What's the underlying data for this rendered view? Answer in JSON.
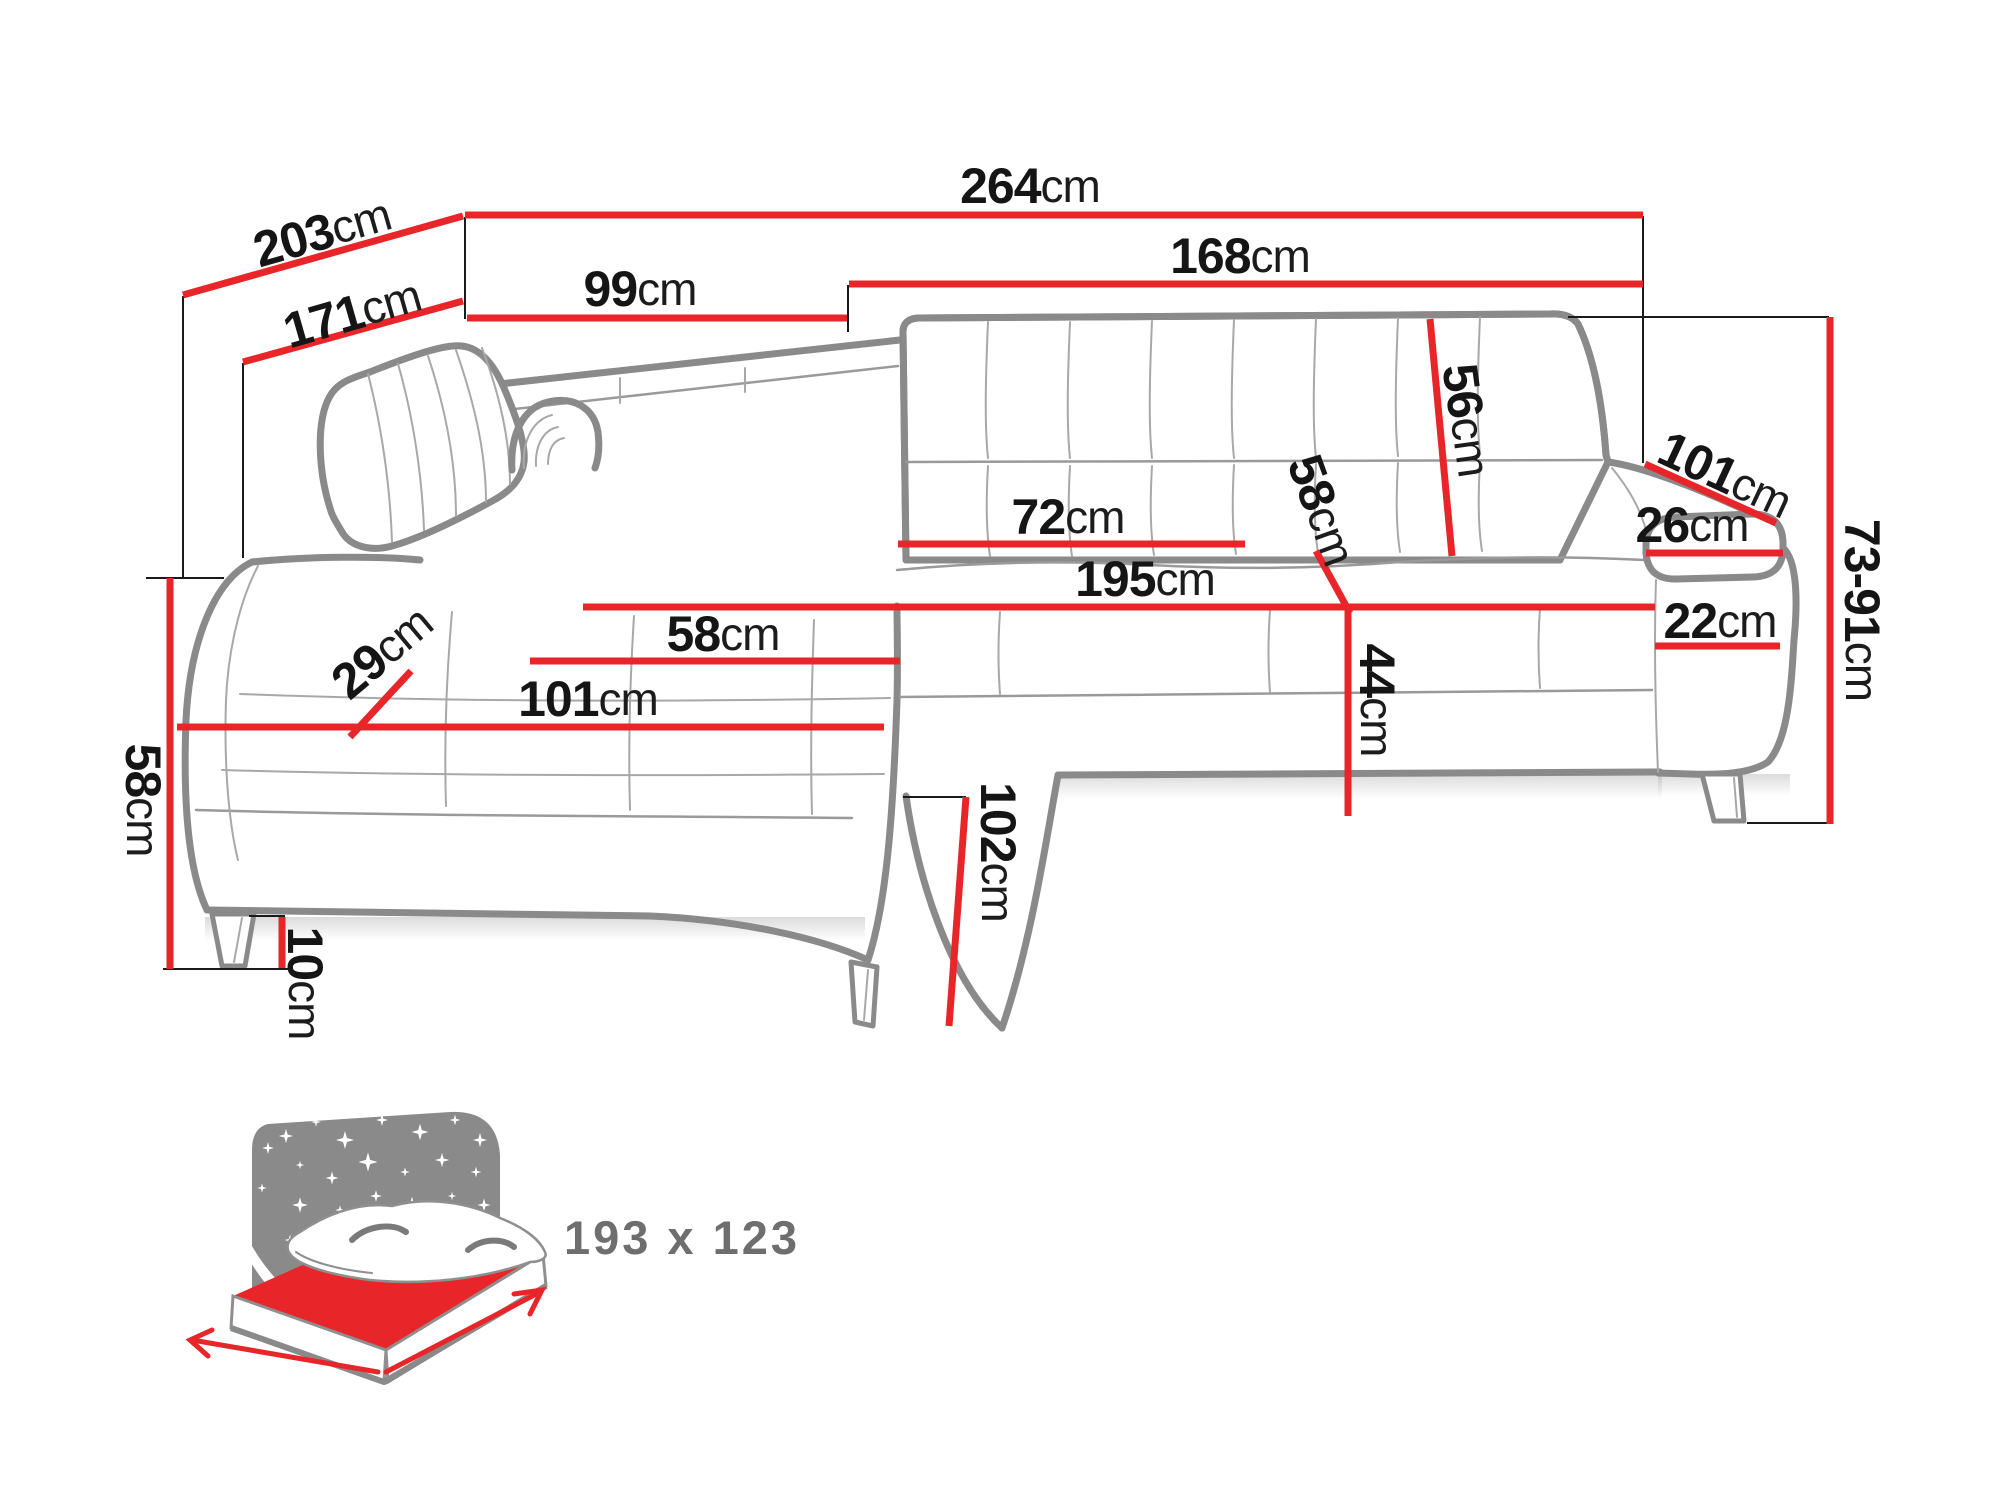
{
  "diagram": {
    "kind": "corner-sofa-dimension-diagram",
    "unit": "cm"
  },
  "theme": {
    "dimension_line_color": "#e8262a",
    "sofa_outline_color": "#8a8a8a",
    "label_text_color": "#151515",
    "muted_text_color": "#6e6e6e",
    "background": "#ffffff"
  },
  "dimensions": [
    {
      "name": "total-width",
      "value": "264",
      "unit": "cm"
    },
    {
      "name": "outer-depth",
      "value": "203",
      "unit": "cm"
    },
    {
      "name": "inner-depth",
      "value": "171",
      "unit": "cm"
    },
    {
      "name": "left-back-width",
      "value": "99",
      "unit": "cm"
    },
    {
      "name": "right-back-width",
      "value": "168",
      "unit": "cm"
    },
    {
      "name": "backrest-height",
      "value": "56",
      "unit": "cm"
    },
    {
      "name": "armrest-length",
      "value": "101",
      "unit": "cm"
    },
    {
      "name": "armrest-cushion-width",
      "value": "26",
      "unit": "cm"
    },
    {
      "name": "overall-height-range",
      "value": "73-91",
      "unit": "cm"
    },
    {
      "name": "backrest-section-width",
      "value": "72",
      "unit": "cm"
    },
    {
      "name": "seat-depth",
      "value": "58",
      "unit": "cm"
    },
    {
      "name": "seat-width",
      "value": "195",
      "unit": "cm"
    },
    {
      "name": "seat-height",
      "value": "44",
      "unit": "cm"
    },
    {
      "name": "armrest-front-width",
      "value": "22",
      "unit": "cm"
    },
    {
      "name": "chaise-seat-width",
      "value": "58",
      "unit": "cm"
    },
    {
      "name": "cushion-thickness",
      "value": "29",
      "unit": "cm"
    },
    {
      "name": "chaise-length",
      "value": "101",
      "unit": "cm"
    },
    {
      "name": "side-height",
      "value": "58",
      "unit": "cm"
    },
    {
      "name": "leg-height",
      "value": "10",
      "unit": "cm"
    },
    {
      "name": "front-height",
      "value": "102",
      "unit": "cm"
    }
  ],
  "sleeping_area": {
    "icon": "bed-sleeping-icon",
    "size_label": "193 x 123"
  }
}
